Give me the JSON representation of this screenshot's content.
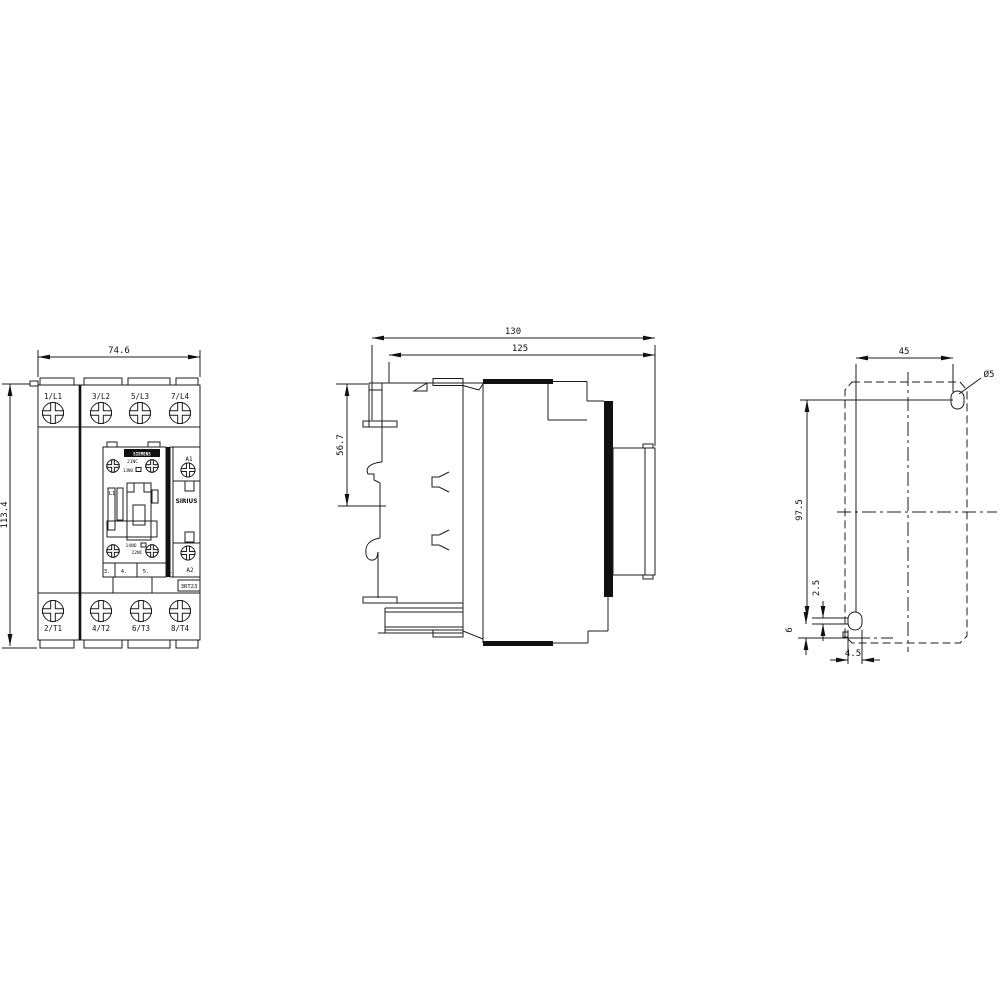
{
  "front": {
    "width": "74.6",
    "height": "113.4",
    "terminals_top": [
      "1/L1",
      "3/L2",
      "5/L3",
      "7/L4"
    ],
    "terminals_bottom": [
      "2/T1",
      "4/T2",
      "6/T3",
      "8/T4"
    ],
    "brand": "SIEMENS",
    "aux_nc_top": "21NC",
    "aux_no_top": "13NO",
    "pole_label": "L1",
    "aux_no_bottom": "14NO",
    "aux_nc_bottom": "22NC",
    "positions": [
      "3.",
      "4.",
      "5.",
      "6."
    ],
    "coil_a1": "A1",
    "coil_a2": "A2",
    "series": "SIRIUS",
    "type_code": "3RT23"
  },
  "side": {
    "depth_total": "130",
    "depth_body": "125",
    "rail_offset": "56.7"
  },
  "drill": {
    "hole_pitch_x": "45",
    "hole_pitch_y": "97.5",
    "hole_dia": "Ø5",
    "slot_play": "2.5",
    "edge_offset": "6",
    "slot_width": "4.5"
  },
  "colors": {
    "line": "#1c1c1c",
    "background": "#ffffff"
  }
}
